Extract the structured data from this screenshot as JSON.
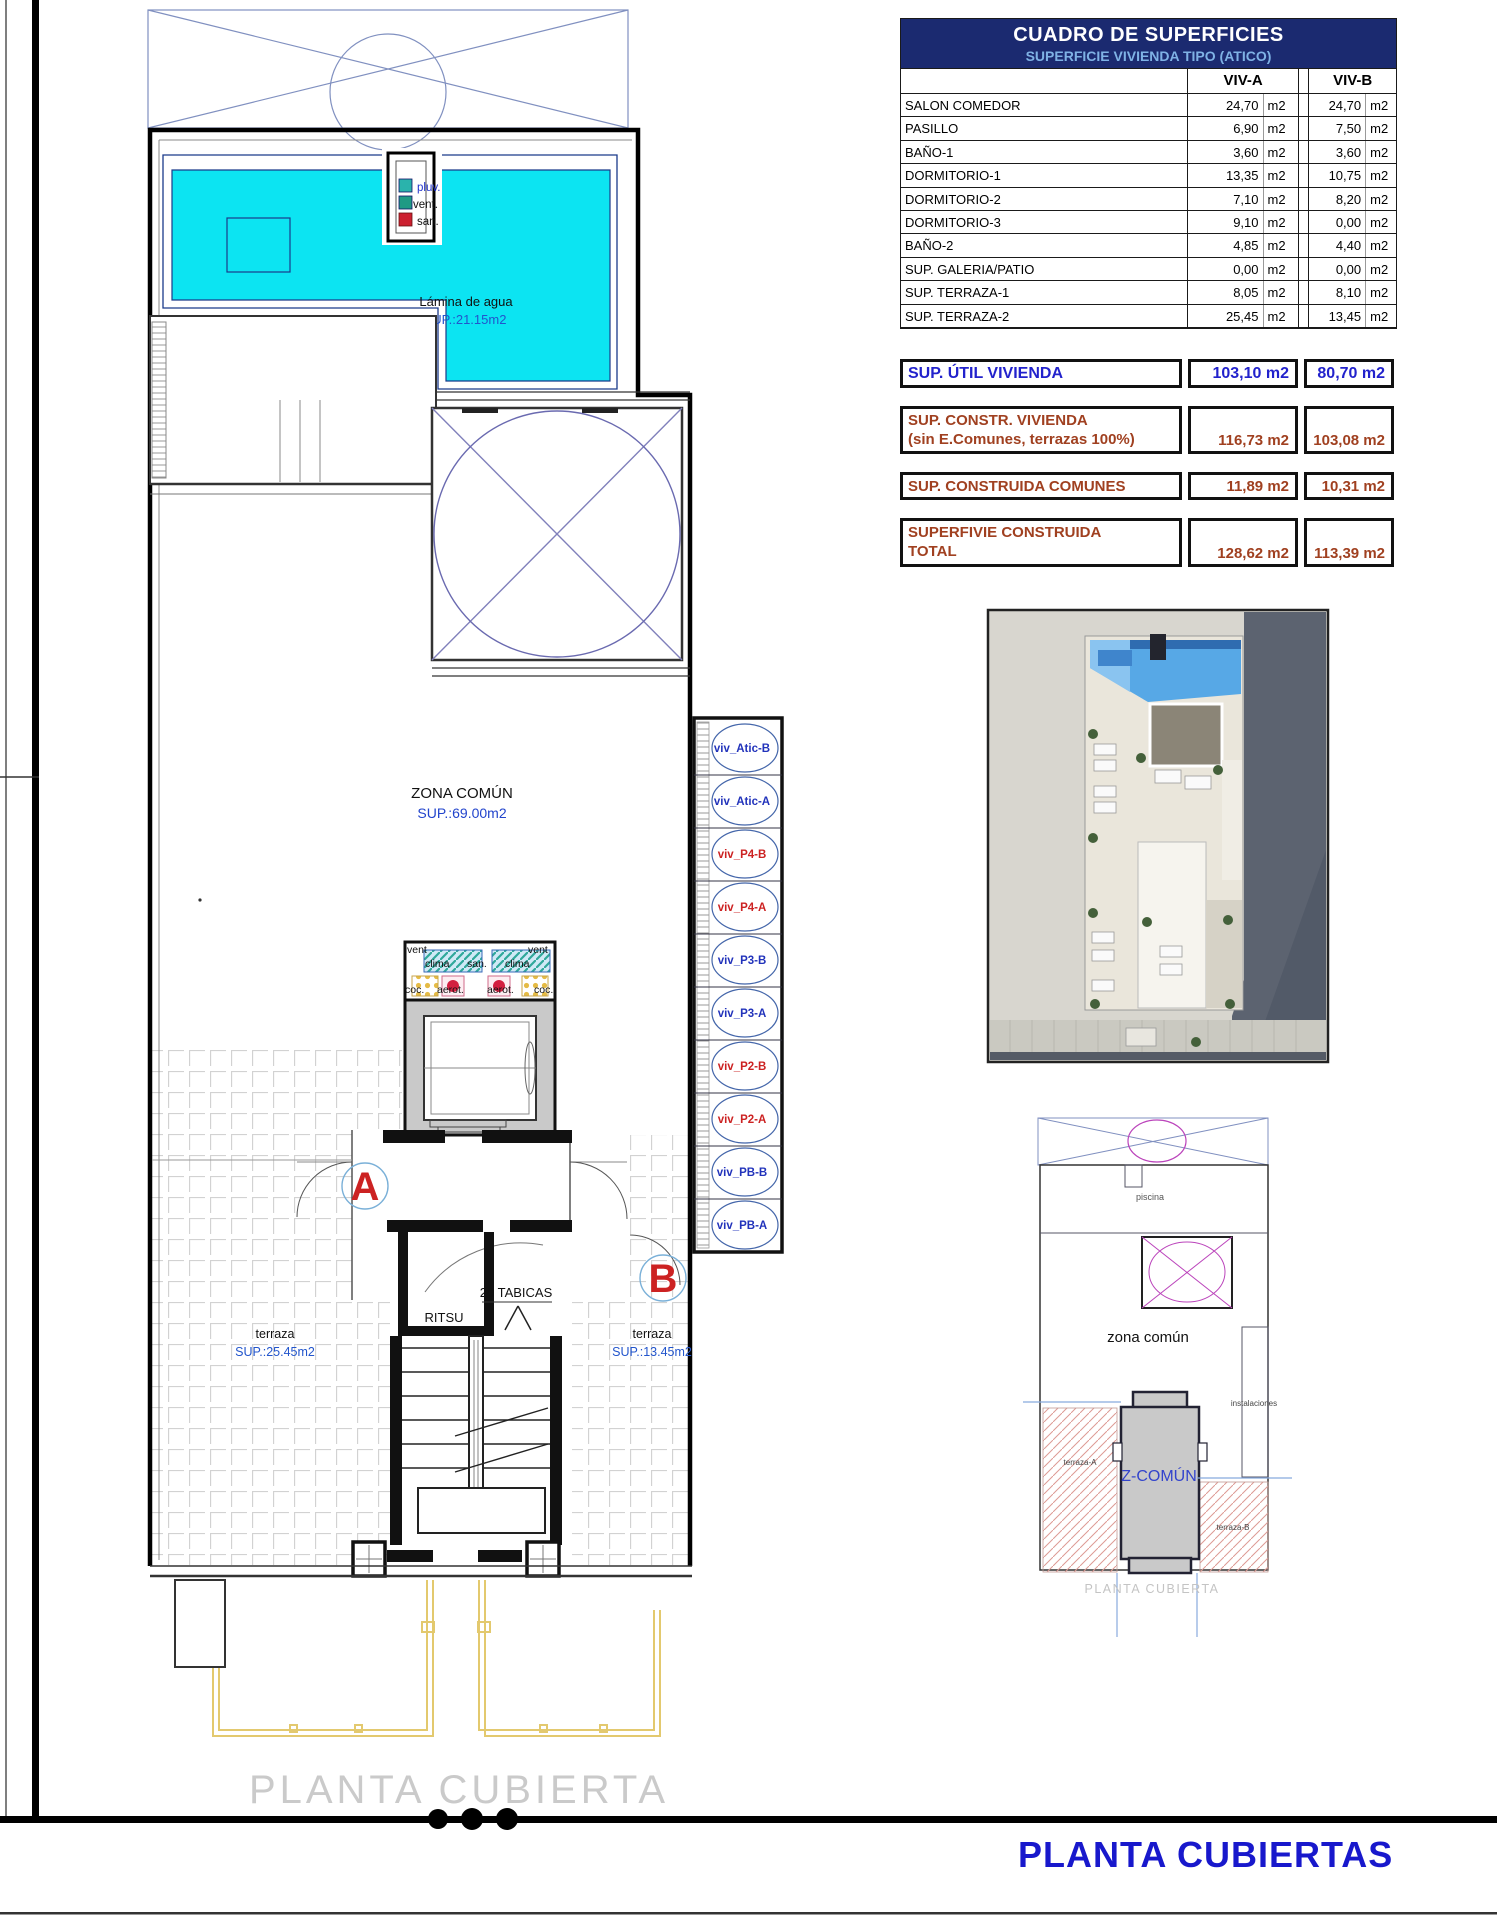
{
  "table": {
    "title": "CUADRO DE SUPERFICIES",
    "subtitle": "SUPERFICIE VIVIENDA TIPO  (ATICO)",
    "col_a": "VIV-A",
    "col_b": "VIV-B",
    "unit": "m2",
    "rows": [
      {
        "label": "SALON COMEDOR",
        "a": "24,70",
        "b": "24,70"
      },
      {
        "label": "PASILLO",
        "a": "6,90",
        "b": "7,50"
      },
      {
        "label": "BAÑO-1",
        "a": "3,60",
        "b": "3,60"
      },
      {
        "label": "DORMITORIO-1",
        "a": "13,35",
        "b": "10,75"
      },
      {
        "label": "DORMITORIO-2",
        "a": "7,10",
        "b": "8,20"
      },
      {
        "label": "DORMITORIO-3",
        "a": "9,10",
        "b": "0,00"
      },
      {
        "label": "BAÑO-2",
        "a": "4,85",
        "b": "4,40"
      },
      {
        "label": "SUP. GALERIA/PATIO",
        "a": "0,00",
        "b": "0,00"
      },
      {
        "label": "SUP. TERRAZA-1",
        "a": "8,05",
        "b": "8,10"
      },
      {
        "label": "SUP. TERRAZA-2",
        "a": "25,45",
        "b": "13,45"
      }
    ],
    "util": {
      "label": "SUP. ÚTIL VIVIENDA",
      "a": "103,10 m2",
      "b": "80,70 m2"
    },
    "constr": {
      "label1": "SUP. CONSTR. VIVIENDA",
      "label2": "(sin E.Comunes, terrazas 100%)",
      "a": "116,73 m2",
      "b": "103,08 m2"
    },
    "comunes": {
      "label": "SUP. CONSTRUIDA COMUNES",
      "a": "11,89 m2",
      "b": "10,31 m2"
    },
    "total": {
      "label1": "SUPERFIVIE CONSTRUIDA",
      "label2": "TOTAL",
      "a": "128,62 m2",
      "b": "113,39 m2"
    }
  },
  "plan": {
    "pool_label": "Lámina de agua",
    "pool_area": "SUP.:21.15m2",
    "zona_comun_label": "ZONA COMÚN",
    "zona_comun_area": "SUP.:69.00m2",
    "shaft": {
      "pluv": "pluv.",
      "vent": "vent.",
      "san": "san."
    },
    "inst": {
      "vent": "vent",
      "clima": "clima",
      "coc": "coc.",
      "aerot": "aerot.",
      "san": "san."
    },
    "door_a": "A",
    "door_b": "B",
    "ritsu": "RITSU",
    "tabicas": "20 TABICAS",
    "terraza_a_label": "terraza",
    "terraza_a_area": "SUP.:25.45m2",
    "terraza_b_label": "terraza",
    "terraza_b_area": "SUP.:13.45m2",
    "caption": "PLANTA CUBIERTA",
    "viv_labels": [
      "viv_Atic-B",
      "viv_Atic-A",
      "viv_P4-B",
      "viv_P4-A",
      "viv_P3-B",
      "viv_P3-A",
      "viv_P2-B",
      "viv_P2-A",
      "viv_PB-B",
      "viv_PB-A"
    ]
  },
  "keyplan": {
    "piscina": "piscina",
    "zona_comun": "zona común",
    "instalaciones": "instalaciones",
    "terraza_a": "terraza-A",
    "terraza_b": "terraza-B",
    "z_comun": "Z-COMÚN",
    "caption": "PLANTA CUBIERTA"
  },
  "footer_title": "PLANTA CUBIERTAS"
}
